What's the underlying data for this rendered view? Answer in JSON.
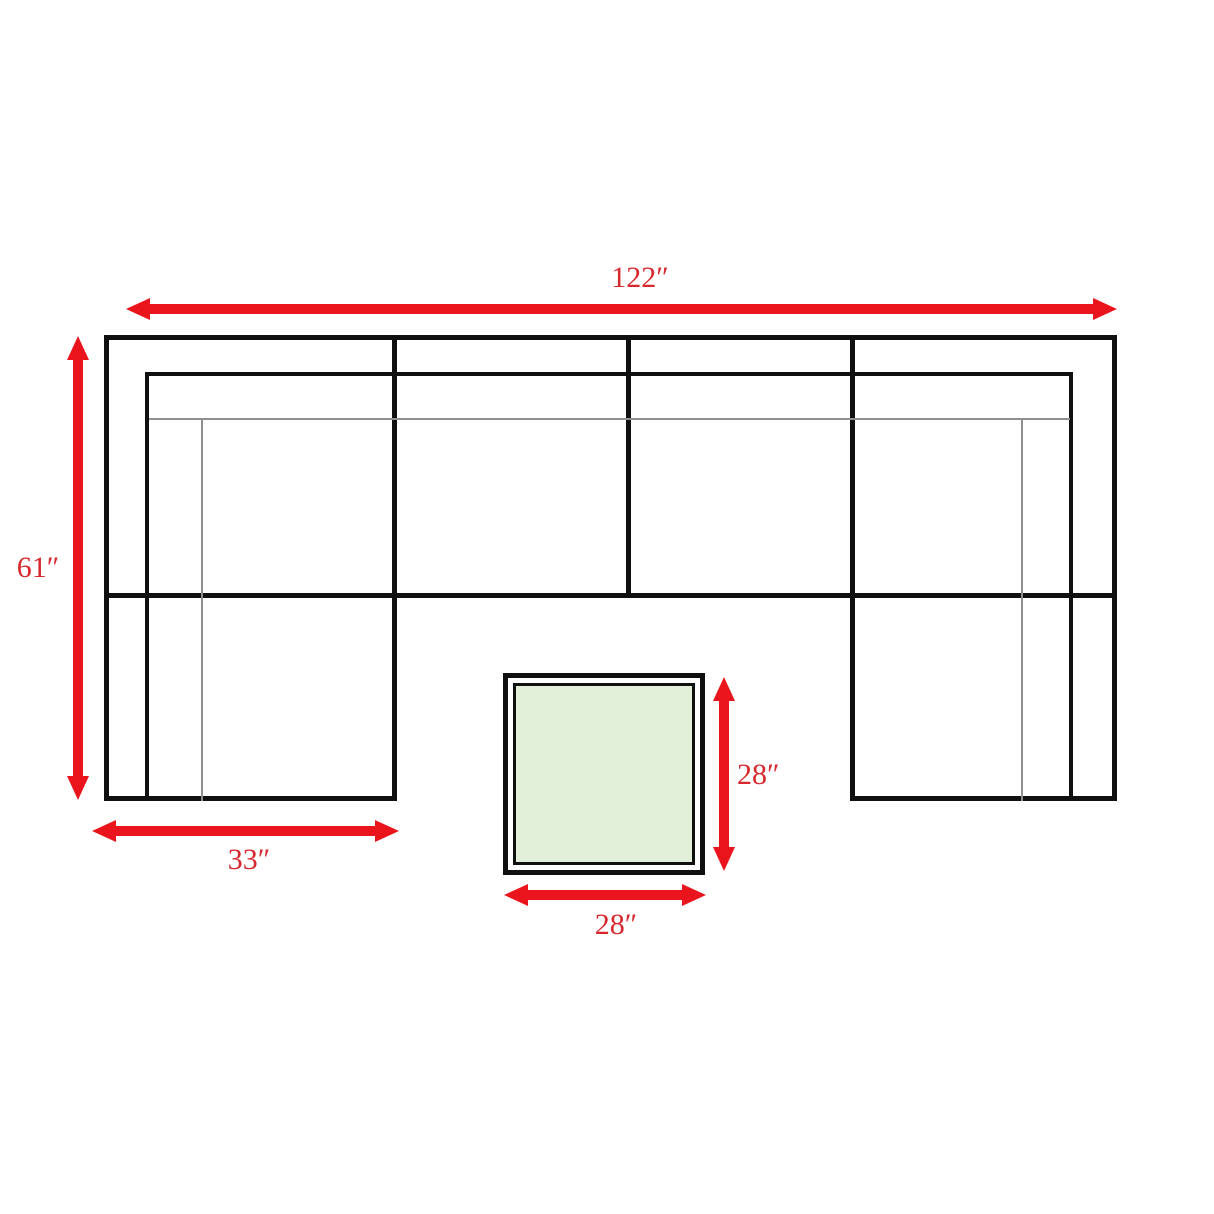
{
  "diagram": {
    "dimensions": {
      "sofa_total_width": "122″",
      "sofa_total_depth": "61″",
      "left_chaise_width": "33″",
      "table_depth": "28″",
      "table_width": "28″"
    },
    "colors": {
      "arrow": "#ea151c",
      "label": "#d8282e",
      "outline": "#101010",
      "thin_line": "#8f8f8f",
      "table_fill": "#e2efd9",
      "background": "#ffffff"
    }
  }
}
